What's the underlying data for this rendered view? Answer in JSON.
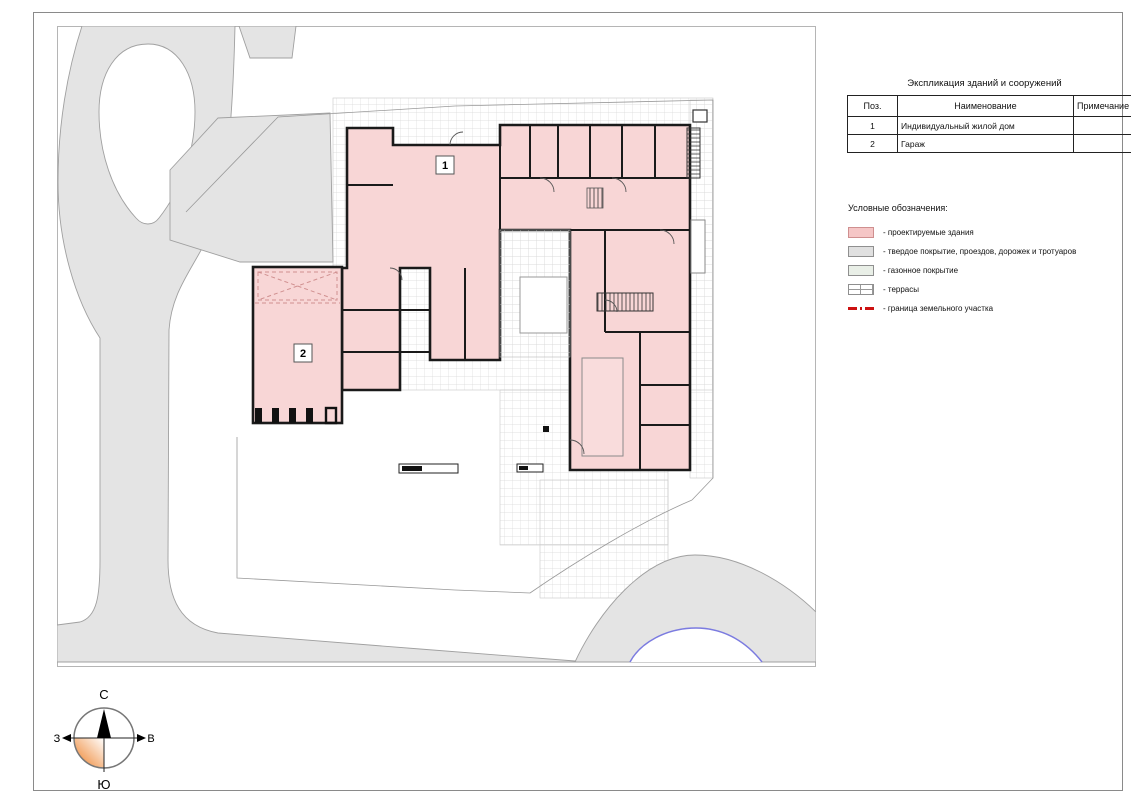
{
  "table": {
    "title": "Экспликация зданий и сооружений",
    "columns": [
      "Поз.",
      "Наименование",
      "Примечание"
    ],
    "rows": [
      [
        "1",
        "Индивидуальный жилой дом",
        ""
      ],
      [
        "2",
        "Гараж",
        ""
      ]
    ]
  },
  "legend": {
    "title": "Условные обозначения:",
    "items": [
      {
        "label": "- проектируемые здания",
        "color": "#f5c6c6"
      },
      {
        "label": "- твердое покрытие, проездов, дорожек и тротуаров",
        "color": "#e0e0e0"
      },
      {
        "label": "- газонное покрытие",
        "color": "#e9efe7"
      },
      {
        "label": "- террасы",
        "color": "#ffffff"
      },
      {
        "label": "- граница земельного участка",
        "color": "#cc1111"
      }
    ]
  },
  "plan": {
    "labels": {
      "house": "1",
      "garage": "2"
    }
  },
  "compass": {
    "north": "С",
    "south": "Ю",
    "west": "З",
    "east": "В"
  }
}
